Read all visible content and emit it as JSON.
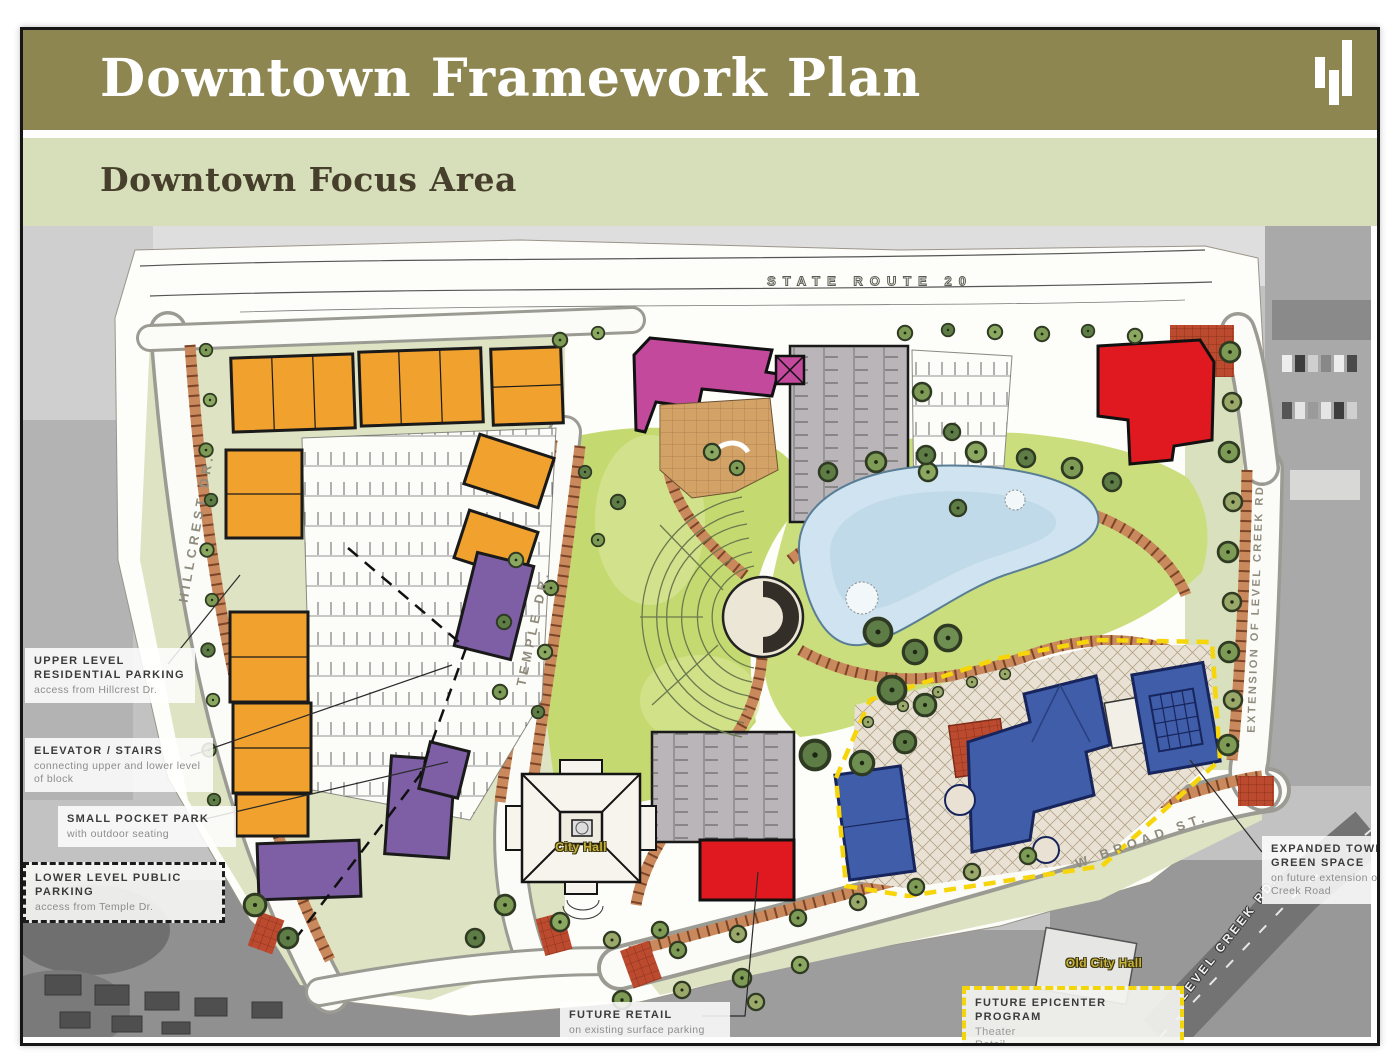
{
  "slide": {
    "title": "Downtown Framework Plan",
    "subtitle": "Downtown Focus Area",
    "logo": "bar-chart-logo"
  },
  "colors": {
    "header_bg": "#8d8651",
    "header_text": "#ffffff",
    "subheader_bg": "#d6dfba",
    "subheader_text": "#463f2b",
    "residential_orange": "#f1a12d",
    "mixed_use_purple": "#7e5fa6",
    "civic_magenta": "#c2499c",
    "retail_red": "#e0181f",
    "epicenter_blue": "#3f5da8",
    "park_green": "#c4da70",
    "pond_blue": "#cfe4f0",
    "boundary_yellow": "#f6d60a"
  },
  "map": {
    "streets": [
      {
        "id": "state-route-20",
        "text": "STATE ROUTE 20"
      },
      {
        "id": "hillcrest-dr",
        "text": "HILLCREST DR."
      },
      {
        "id": "temple-dr",
        "text": "TEMPLE DR."
      },
      {
        "id": "extension-of-level-creek-rd",
        "text": "EXTENSION OF LEVEL CREEK RD."
      },
      {
        "id": "w-broad-st",
        "text": "W BROAD ST."
      },
      {
        "id": "level-creek-rd",
        "text": "LEVEL CREEK RD."
      }
    ],
    "places": [
      {
        "id": "city-hall",
        "text": "City Hall"
      },
      {
        "id": "old-city-hall",
        "text": "Old City Hall"
      }
    ],
    "annotations": [
      {
        "id": "upper-level-residential-parking",
        "title": "UPPER LEVEL RESIDENTIAL PARKING",
        "body": "access from Hillcrest Dr."
      },
      {
        "id": "elevator-stairs",
        "title": "ELEVATOR / STAIRS",
        "body": "connecting upper and lower level of block"
      },
      {
        "id": "small-pocket-park",
        "title": "SMALL POCKET PARK",
        "body": "with outdoor seating"
      },
      {
        "id": "lower-level-public-parking",
        "title": "LOWER LEVEL PUBLIC PARKING",
        "body": "access from Temple Dr."
      },
      {
        "id": "future-retail",
        "title": "FUTURE RETAIL",
        "body": "on existing surface parking"
      },
      {
        "id": "expanded-town-green-space",
        "title": "EXPANDED TOWN GREEN SPACE",
        "body": "on future extension of Level Creek Road"
      },
      {
        "id": "future-epicenter-program",
        "title": "FUTURE EPICENTER PROGRAM",
        "body_lines": [
          "Theater",
          "Retail"
        ]
      }
    ]
  }
}
